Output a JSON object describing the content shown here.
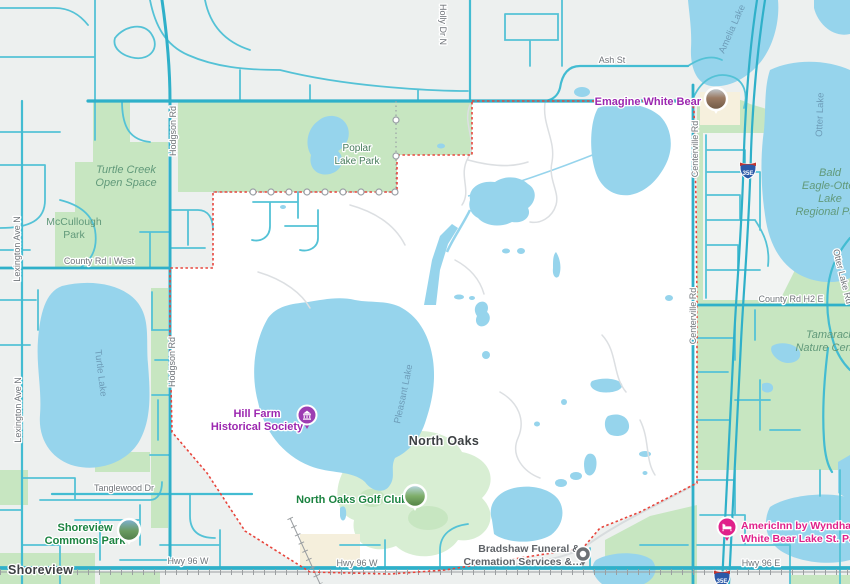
{
  "map_type": "google-maps-area-view",
  "selected_region": "North Oaks",
  "cities": {
    "shoreview": "Shoreview",
    "north_oaks": "North Oaks"
  },
  "roads": {
    "ash": "Ash St",
    "holly": "Holly Dr N",
    "hodgson": "Hodgson Rd",
    "centerville": "Centerville Rd",
    "lexington": "Lexington Ave N",
    "county_i": "County Rd I West",
    "county_h2": "County Rd H2 E",
    "otter_lake_rd": "Otter Lake Rd",
    "tanglewood": "Tanglewood Dr",
    "hwy96w": "Hwy 96 W",
    "hwy96e": "Hwy 96 E",
    "interstate_shield": "35E"
  },
  "waters": {
    "amelia": "Amelia Lake",
    "otter": "Otter Lake",
    "turtle": "Turtle Lake",
    "pleasant": "Pleasant Lake"
  },
  "parks": {
    "poplar": {
      "line1": "Poplar",
      "line2": "Lake Park"
    },
    "turtle_creek": {
      "line1": "Turtle Creek",
      "line2": "Open Space"
    },
    "mccullough": {
      "line1": "McCullough",
      "line2": "Park"
    },
    "bald_eagle": {
      "line1": "Bald",
      "line2": "Eagle-Otter",
      "line3": "Lake",
      "line4": "Regional Park"
    },
    "tamarack": {
      "line1": "Tamarack",
      "line2": "Nature Center"
    }
  },
  "pois": {
    "emagine": {
      "label": "Emagine White Bear"
    },
    "hill_farm": {
      "line1": "Hill Farm",
      "line2": "Historical Society"
    },
    "golf": {
      "label": "North Oaks Golf Club"
    },
    "commons": {
      "line1": "Shoreview",
      "line2": "Commons Park"
    },
    "americinn": {
      "line1": "AmericInn by Wyndham",
      "line2": "White Bear Lake St. Paul"
    },
    "bradshaw": {
      "line1": "Bradshaw Funeral &",
      "line2": "Cremation Services &…"
    }
  },
  "colors": {
    "land": "#edf0ef",
    "selected_region_fill": "#ffffff",
    "water": "#96d4ec",
    "park_green": "#c7e6c1",
    "golf_green": "#d8eed3",
    "road_teal": "#54c2d6",
    "road_major": "#2fb0c9",
    "boundary_red": "#e8453c",
    "poi_purple": "#9c27b0",
    "poi_pink": "#e0218a",
    "poi_green": "#1b8340",
    "water_label": "#6d9cb8",
    "park_label": "#61997a",
    "road_label": "#70757a",
    "city_label": "#3c4043"
  }
}
